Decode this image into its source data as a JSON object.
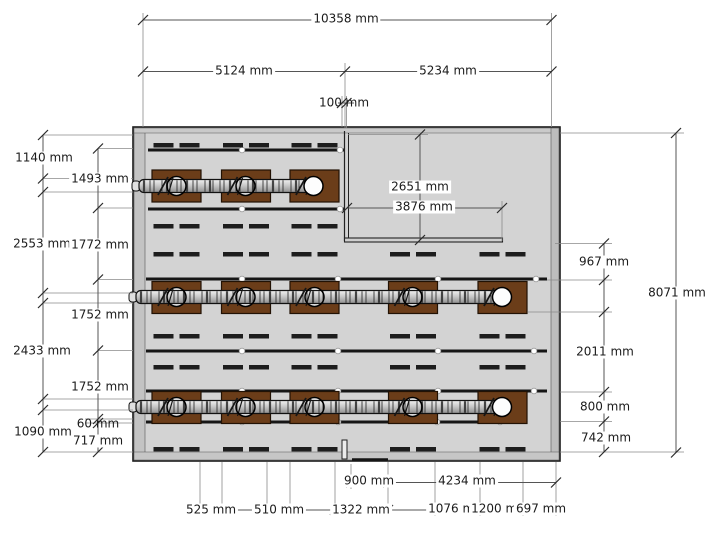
{
  "drawing": {
    "unit": "mm",
    "colors": {
      "floor_gray": "#d3d3d3",
      "equipment_brown": "#6b3d19",
      "line_dark": "#161616"
    }
  },
  "dims": {
    "top_overall": "10358 mm",
    "top_span_left": "5124 mm",
    "top_span_right": "5234 mm",
    "top_wall": "100 mm",
    "left_1140": "1140 mm",
    "left_1493": "1493 mm",
    "left_2553": "2553 mm",
    "left_1772": "1772 mm",
    "left_1752_a": "1752 mm",
    "left_2433": "2433 mm",
    "left_1752_b": "1752 mm",
    "left_60": "60 mm",
    "left_1090": "1090 mm",
    "left_717": "717 mm",
    "cutout_height": "2651 mm",
    "cutout_width": "3876 mm",
    "right_967": "967 mm",
    "right_8071": "8071 mm",
    "right_2011": "2011 mm",
    "right_800": "800 mm",
    "right_742": "742 mm",
    "bottom_900": "900 mm",
    "bottom_4234": "4234 mm",
    "bottom_525": "525 mm",
    "bottom_510": "510 mm",
    "bottom_1322": "1322 mm",
    "bottom_1076": "1076 mm",
    "bottom_1200": "1200 mm",
    "bottom_697": "697 mm"
  }
}
